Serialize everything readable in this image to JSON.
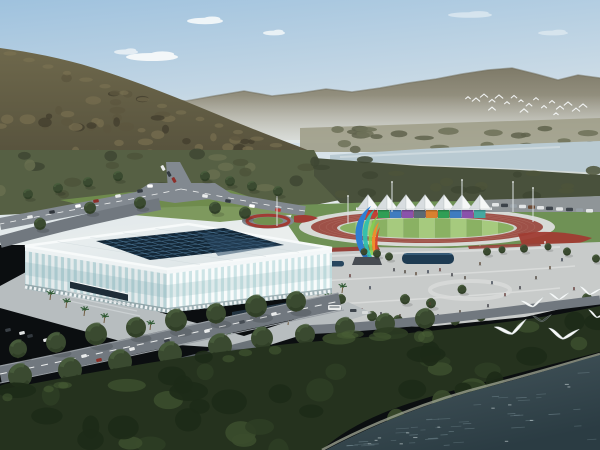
{
  "scene": {
    "description": "Aerial architectural rendering: white lattice gymnasium beside an athletics track with white canopy grandstand, colorful ribbon sculpture, pedestrian plaza, riverside forest, distant mountains and flying egrets",
    "width": 600,
    "height": 450
  },
  "colors": {
    "sky_top": "#9fc2de",
    "sky_mid": "#cddce6",
    "sky_low": "#eaeeed",
    "cloud": "#f7fafb",
    "range_top": "#7e7a68",
    "range_base": "#b2afa0",
    "range_ridge": "#6f6b5a",
    "haze": "#e2e7e6",
    "fields": "#a09e8a",
    "far_tree1": "#6d7158",
    "far_tree2": "#5f634c",
    "river": "#b9cad2",
    "river_light": "#d6e0e3",
    "bank": "#c9cfc8",
    "mtn_top": "#6e684c",
    "mtn_base": "#4e4a37",
    "mtn_t1": "#746c4e",
    "mtn_t2": "#5c563f",
    "mtn_t3": "#433f2e",
    "mtn_sun": "#7d7454",
    "band_left": "#566044",
    "band_right": "#49513c",
    "band_blob1": "#4c5339",
    "band_blob2": "#676e4f",
    "band_blob3": "#3e4632",
    "lawn": "#6f9155",
    "grass_light": "#72904f",
    "road": "#828990",
    "road_dark": "#71787f",
    "road_darker": "#636a71",
    "road_edge": "#9aa0a5",
    "dash": "#eceeee",
    "park_strip": "#8f9598",
    "ring_white": "#d7dad6",
    "track_red": "#9e5148",
    "lane": "#b5786d",
    "inner_white": "#cfd3cd",
    "infield_a": "#8ab163",
    "infield_b": "#a6ca7e",
    "flower": "#a03c33",
    "flower_dark": "#96423a",
    "tent_light": "#f5f7f7",
    "tent_shade": "#d8dde0",
    "tent_edge": "#b9c0c3",
    "beam": "#e9edee",
    "pole": "#9aa2a6",
    "pole_light": "#dde2e4",
    "plaza": "#c8cbca",
    "plaza_band": "#d9dbda",
    "pool": "#1e3b52",
    "pool_rim": "#4f7a9b",
    "pool2": "#27465e",
    "apron": "#b7bdbf",
    "wall_glass_l": "#b7d2d6",
    "wall_glass_r": "#cde4e6",
    "rib_l": "#e4ebec",
    "rib_r": "#f8fbfb",
    "wall_top_l": "#edf2f3",
    "wall_top_r": "#f3f7f8",
    "wall_base_l": "#93a7ab",
    "wall_base_r": "#9fb2b6",
    "arch": "#eef3f4",
    "glass_shade": "#8fb6bd",
    "roof_a": "#ecf1f2",
    "roof_b": "#dce4e6",
    "fascia": "#f7fafa",
    "roof_seam": "#c9d4d7",
    "skylight": "#142838",
    "sky_grid": "#4a7392",
    "sky_reflect": "#2b4a66",
    "canopy_dark": "#1e2d38",
    "canopy_dark2": "#223340",
    "steps": "#cfd5d7",
    "tree_canopy": "#3a4a30",
    "tree_dark": "#2c3a24",
    "tree_hi": "#4d6340",
    "trunk": "#4a392b",
    "palm_frond": "#2f5a33",
    "palm_trunk": "#705c40",
    "forest": "#25321e",
    "forest_d1": "#1d2a17",
    "forest_d2": "#2e3d24",
    "forest_l": "#3b4d2c",
    "forest_hi": "#4a5f36",
    "shore": "#9aa08f",
    "water_near": "#48595f",
    "water_far": "#2b3c43",
    "ripple": "#7b929a",
    "fleck": "#ccd8d9",
    "bird": "#f6f8f8",
    "bird_dark": "#3a4440",
    "sculpt_blue": "#2d7fd2",
    "sculpt_teal": "#2fbfae",
    "sculpt_green": "#86cf4e",
    "sculpt_orange": "#ef8d2b",
    "sculpt_red": "#d84a2b",
    "pedestal": "#474c52",
    "bus": "#e8eaea",
    "bus_win": "#7c8489"
  },
  "clouds": [
    {
      "x": 205,
      "y": 21,
      "rx": 18,
      "ry": 3.2,
      "o": 0.9
    },
    {
      "x": 152,
      "y": 57,
      "rx": 26,
      "ry": 4.0,
      "o": 0.95
    },
    {
      "x": 126,
      "y": 52,
      "rx": 12,
      "ry": 2.6,
      "o": 0.7
    },
    {
      "x": 274,
      "y": 33,
      "rx": 11,
      "ry": 2.4,
      "o": 0.8
    },
    {
      "x": 470,
      "y": 15,
      "rx": 22,
      "ry": 2.8,
      "o": 0.5
    },
    {
      "x": 553,
      "y": 33,
      "rx": 15,
      "ry": 2.4,
      "o": 0.45
    }
  ],
  "tents": {
    "xs": [
      368,
      387,
      406,
      425,
      444,
      462,
      480
    ],
    "base_y": 209,
    "peak_y": 194.5,
    "half_w": 11
  },
  "containers": [
    {
      "x": 366,
      "c": "#c24036"
    },
    {
      "x": 378,
      "c": "#2f9e55"
    },
    {
      "x": 390,
      "c": "#3f7cc0"
    },
    {
      "x": 402,
      "c": "#8a52ab"
    },
    {
      "x": 414,
      "c": "#5b6a74"
    },
    {
      "x": 426,
      "c": "#d8812f"
    },
    {
      "x": 438,
      "c": "#2f9e55"
    },
    {
      "x": 450,
      "c": "#3f7cc0"
    },
    {
      "x": 462,
      "c": "#8a52ab"
    },
    {
      "x": 474,
      "c": "#46a8a0"
    }
  ],
  "infield": {
    "x0": 340,
    "w": 15.8,
    "n": 11
  },
  "mid_cars": [
    [
      163,
      168,
      "#e9ebeb",
      62
    ],
    [
      169,
      174,
      "#343b41",
      62
    ],
    [
      174,
      180,
      "#8d2f2a",
      62
    ],
    [
      150,
      186,
      "#ffffff",
      0
    ],
    [
      140,
      191,
      "#343b41",
      -8
    ],
    [
      118,
      196,
      "#e9ebeb",
      -10
    ],
    [
      96,
      201,
      "#8d2f2a",
      -10
    ],
    [
      78,
      206,
      "#ffffff",
      -10
    ],
    [
      52,
      212,
      "#2f353b",
      -10
    ],
    [
      30,
      217,
      "#e9ebeb",
      -10
    ],
    [
      205,
      196,
      "#e9ebeb",
      8
    ],
    [
      228,
      201,
      "#343b41",
      8
    ],
    [
      252,
      206,
      "#ffffff",
      8
    ],
    [
      278,
      210,
      "#c03a31",
      8
    ]
  ],
  "bottom_cars": [
    [
      30,
      336,
      "#32383e",
      -12
    ],
    [
      46,
      340,
      "#e9ebeb",
      -12
    ],
    [
      61,
      344,
      "#8e2f28",
      -12
    ],
    [
      84,
      356,
      "#e9ebeb",
      -12
    ],
    [
      99,
      360,
      "#8e2f28",
      -12
    ],
    [
      132,
      349,
      "#e9ebeb",
      -13
    ],
    [
      167,
      341,
      "#373d44",
      -13
    ],
    [
      207,
      331,
      "#e9ebeb",
      -13
    ],
    [
      242,
      322,
      "#454c53",
      -13
    ],
    [
      274,
      314,
      "#e9ebeb",
      -12
    ],
    [
      8,
      330,
      "#3a4046",
      -12
    ],
    [
      22,
      333,
      "#dfe2e2",
      -12
    ]
  ],
  "parked_right": {
    "cars": [
      [
        492,
        203
      ],
      [
        501,
        203.6
      ],
      [
        510,
        204.2
      ],
      [
        519,
        204.8
      ],
      [
        528,
        205.4
      ],
      [
        537,
        206
      ],
      [
        546,
        206.6
      ],
      [
        556,
        207.2
      ],
      [
        566,
        207.8
      ],
      [
        576,
        208.4
      ],
      [
        586,
        209
      ]
    ],
    "colors": [
      "#e3e6e7",
      "#3c434a",
      "#98a1a7",
      "#e3e6e7",
      "#6b4a35",
      "#e3e6e7",
      "#3c434a"
    ]
  },
  "poles": [
    [
      392,
      182,
      212
    ],
    [
      462,
      180,
      210
    ],
    [
      513,
      182,
      212
    ],
    [
      533,
      188,
      222
    ],
    [
      277,
      194,
      226
    ],
    [
      348,
      196,
      224
    ],
    [
      420,
      250,
      266
    ],
    [
      480,
      246,
      262
    ],
    [
      545,
      242,
      258
    ]
  ],
  "people": {
    "positions": [
      [
        311,
        281
      ],
      [
        318,
        292
      ],
      [
        330,
        299
      ],
      [
        345,
        304
      ],
      [
        362,
        308
      ],
      [
        381,
        312
      ],
      [
        400,
        314
      ],
      [
        419,
        316
      ],
      [
        438,
        314
      ],
      [
        300,
        265
      ],
      [
        394,
        268
      ],
      [
        405,
        270
      ],
      [
        416,
        272
      ],
      [
        428,
        270
      ],
      [
        440,
        268
      ],
      [
        452,
        273
      ],
      [
        465,
        276
      ],
      [
        480,
        262
      ],
      [
        492,
        281
      ],
      [
        505,
        293
      ],
      [
        520,
        286
      ],
      [
        536,
        276
      ],
      [
        550,
        266
      ],
      [
        562,
        258
      ],
      [
        574,
        287
      ],
      [
        488,
        304
      ],
      [
        460,
        310
      ],
      [
        430,
        302
      ],
      [
        370,
        286
      ],
      [
        350,
        274
      ],
      [
        122,
        320
      ],
      [
        136,
        325
      ],
      [
        252,
        336
      ],
      [
        266,
        331
      ],
      [
        302,
        320
      ]
    ],
    "colors": [
      "#2e2f36",
      "#433a30",
      "#55412f",
      "#2b3442",
      "#5a2f2c"
    ]
  },
  "plaza_trees": [
    [
      307,
      262,
      4
    ],
    [
      321,
      288,
      5
    ],
    [
      341,
      301,
      5
    ],
    [
      364,
      253,
      3.5
    ],
    [
      377,
      255,
      4
    ],
    [
      389,
      258,
      4
    ],
    [
      405,
      301,
      5
    ],
    [
      431,
      305,
      5
    ],
    [
      372,
      318,
      5
    ],
    [
      398,
      322,
      5
    ],
    [
      425,
      325,
      5
    ],
    [
      455,
      322,
      5
    ],
    [
      481,
      318,
      5
    ],
    [
      462,
      291,
      4.5
    ],
    [
      487,
      253,
      4
    ],
    [
      502,
      251,
      3.5
    ],
    [
      524,
      250,
      4
    ],
    [
      548,
      248,
      3.5
    ],
    [
      567,
      253,
      4
    ],
    [
      587,
      300,
      5
    ],
    [
      596,
      260,
      4
    ]
  ],
  "road_trees": [
    [
      18,
      352,
      9
    ],
    [
      56,
      346,
      10
    ],
    [
      96,
      338,
      11
    ],
    [
      136,
      331,
      10
    ],
    [
      176,
      324,
      11
    ],
    [
      216,
      317,
      10
    ],
    [
      256,
      310,
      11
    ],
    [
      296,
      305,
      10
    ],
    [
      20,
      380,
      12
    ],
    [
      70,
      374,
      12
    ],
    [
      120,
      366,
      12
    ],
    [
      170,
      358,
      12
    ],
    [
      220,
      350,
      12
    ],
    [
      262,
      342,
      11
    ],
    [
      305,
      338,
      10
    ],
    [
      345,
      331,
      10
    ],
    [
      385,
      327,
      10
    ],
    [
      425,
      322,
      10
    ],
    [
      28,
      196,
      5
    ],
    [
      58,
      190,
      5
    ],
    [
      88,
      184,
      5
    ],
    [
      118,
      178,
      5
    ],
    [
      205,
      178,
      5
    ],
    [
      230,
      183,
      5
    ],
    [
      252,
      188,
      5
    ],
    [
      278,
      193,
      5
    ],
    [
      90,
      210,
      6
    ],
    [
      40,
      226,
      6
    ],
    [
      140,
      205,
      6
    ],
    [
      215,
      210,
      6
    ],
    [
      245,
      215,
      6
    ]
  ],
  "palms": [
    [
      50,
      300
    ],
    [
      66,
      308
    ],
    [
      84,
      316
    ],
    [
      104,
      323
    ],
    [
      150,
      330
    ],
    [
      196,
      336
    ],
    [
      226,
      340
    ],
    [
      258,
      334
    ],
    [
      288,
      325
    ],
    [
      310,
      315
    ],
    [
      328,
      303
    ],
    [
      342,
      293
    ]
  ],
  "distant_birds": [
    [
      468,
      98
    ],
    [
      476,
      100
    ],
    [
      484,
      96
    ],
    [
      492,
      101
    ],
    [
      499,
      97
    ],
    [
      507,
      103
    ],
    [
      514,
      97
    ],
    [
      521,
      101
    ],
    [
      529,
      105
    ],
    [
      536,
      99
    ],
    [
      544,
      107
    ],
    [
      552,
      102
    ],
    [
      560,
      108
    ],
    [
      568,
      104
    ],
    [
      576,
      110
    ],
    [
      583,
      106
    ],
    [
      492,
      109
    ],
    [
      524,
      111
    ],
    [
      556,
      114
    ]
  ],
  "gulls": [
    {
      "x": 533,
      "y": 306,
      "s": 1.1,
      "r": -6,
      "dark": false
    },
    {
      "x": 559,
      "y": 299,
      "s": 0.95,
      "r": 2,
      "dark": false
    },
    {
      "x": 590,
      "y": 294,
      "s": 1.05,
      "r": 8,
      "dark": false
    },
    {
      "x": 512,
      "y": 333,
      "s": 1.5,
      "r": -10,
      "dark": false
    },
    {
      "x": 563,
      "y": 338,
      "s": 1.4,
      "r": 6,
      "dark": false
    },
    {
      "x": 542,
      "y": 321,
      "s": 0.85,
      "r": 0,
      "dark": true
    },
    {
      "x": 597,
      "y": 317,
      "s": 0.9,
      "r": 12,
      "dark": false
    }
  ],
  "plaza_vehicles": {
    "bus": [
      328,
      305
    ],
    "car1": [
      350,
      309
    ],
    "car2": [
      362,
      311
    ]
  }
}
